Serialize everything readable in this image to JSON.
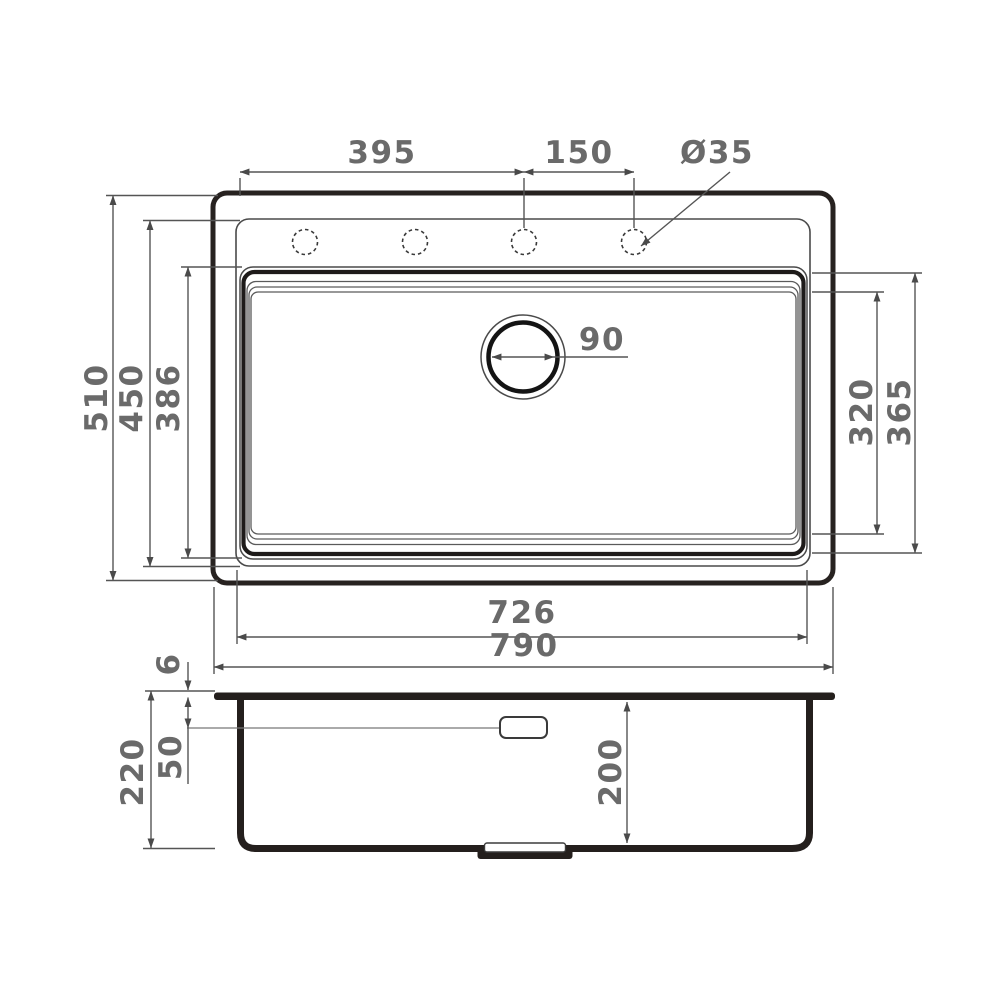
{
  "page": {
    "background": "#ffffff"
  },
  "drawing": {
    "type": "technical-dimension-drawing",
    "subject": "kitchen sink: top plan view and side section view",
    "line_color": "#272220",
    "dim_color": "#6a6a6a",
    "dimensions": {
      "faucet_offset": "395",
      "hole_spacing": "150",
      "hole_diameter": "Ø35",
      "overall_width": "510",
      "rim_width": "450",
      "bowl_width": "386",
      "drain_diameter": "90",
      "bowl_span_inner": "320",
      "bowl_span_outer": "365",
      "rim_length": "726",
      "overall_length": "790",
      "lip_height": "6",
      "overflow_offset": "50",
      "overall_height": "220",
      "bowl_depth": "200"
    }
  }
}
